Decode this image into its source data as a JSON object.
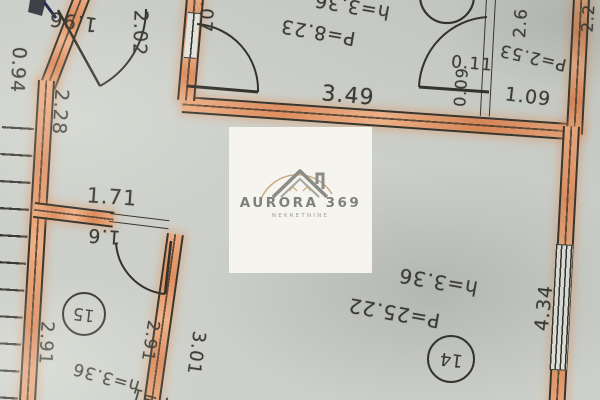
{
  "watermark": {
    "brand": "AURORA 369",
    "tagline": "NEKRETNINE"
  },
  "colors": {
    "paper": "#cdd0ca",
    "wall_highlight": "#e8a478",
    "line": "#37352c",
    "watermark_bg": "#f5f4ef",
    "logo_gray": "#8b8b87",
    "logo_tan": "#c9a87c"
  },
  "rooms": {
    "hall": {
      "perimeter": "P=8.23",
      "height": "h=3.36"
    },
    "wc": {
      "perimeter": "P=2.53"
    },
    "room14": {
      "number": "14",
      "perimeter": "P=25.22",
      "height": "h=3.36"
    },
    "room15": {
      "number": "15",
      "perimeter": "P=1",
      "height": "h=3.36"
    }
  },
  "dimensions": {
    "d196": "1.96",
    "d094": "0.94",
    "d228": "2.28",
    "d202": "2.02",
    "d107": "1.07",
    "d349": "3.49",
    "d48": "4.8",
    "d011": "0.11",
    "d009": "0.09",
    "d109": "1.09",
    "d26": "2.6",
    "d22": "2.2",
    "d171": "1.71",
    "d16": "1.6",
    "d291_left": "2.91",
    "d291_right": "2.91",
    "d301": "3.01",
    "d434": "4.34"
  }
}
